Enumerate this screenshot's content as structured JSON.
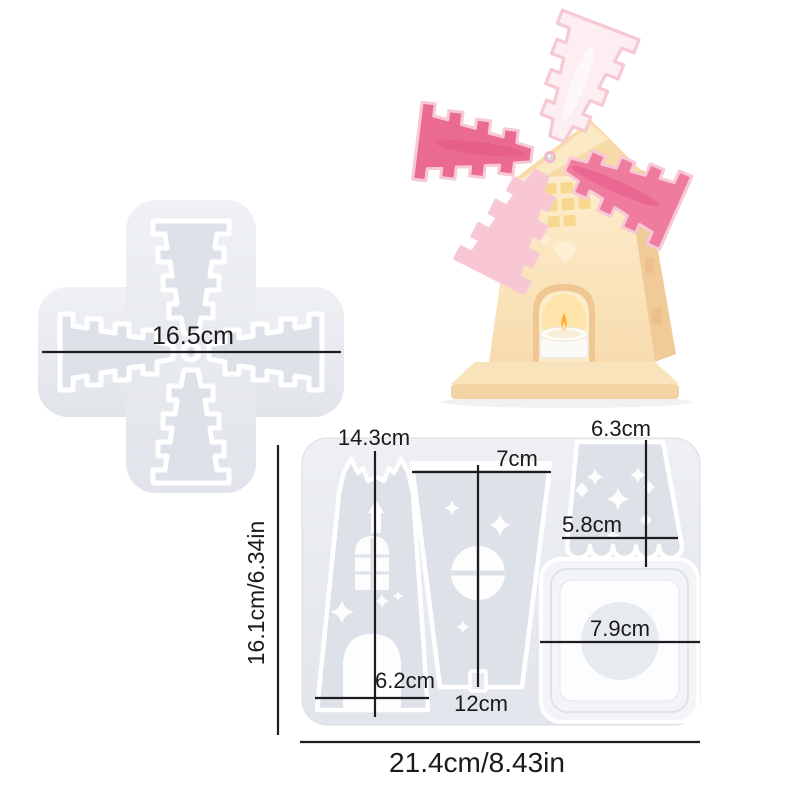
{
  "page": {
    "background": "#ffffff"
  },
  "colors": {
    "dimension_line": "#1d1d1f",
    "label_text": "#1a1a1a",
    "mold_body_light": "#eef0f4",
    "mold_body_dark": "#e2e5eb",
    "mold_cavity": "#dde1e8",
    "cavity_outline": "#ffffff",
    "cavity_detail": "#fdfdfe",
    "square_cavity_outer": "#f2f4f8",
    "square_cavity_inner": "#fcfdfe",
    "square_cavity_circle": "#e7eaef",
    "windmill_body": "#fdedcd",
    "windmill_body_shade": "#f1cb97",
    "windmill_roof": "#f8d9a8",
    "windmill_window_glow": "#f6d98e",
    "blade_pink_strong": "#ea6a90",
    "blade_pink_mid": "#ef7b9e",
    "blade_pink_pale": "#f7c6d2",
    "blade_pink_light": "#fdeef1",
    "flame": "#ffae3b",
    "candle": "#fbfaf6"
  },
  "blade_mold": {
    "width_label": "16.5cm"
  },
  "panel_mold": {
    "tower_height_label": "14.3cm",
    "tower_width_label": "6.2cm",
    "wall_width_label": "7cm",
    "wall_height_label": "12cm",
    "roof_height_label": "6.3cm",
    "roof_width_label": "5.8cm",
    "base_width_label": "7.9cm",
    "overall_height_label": "16.1cm/6.34in",
    "overall_width_label": "21.4cm/8.43in"
  }
}
